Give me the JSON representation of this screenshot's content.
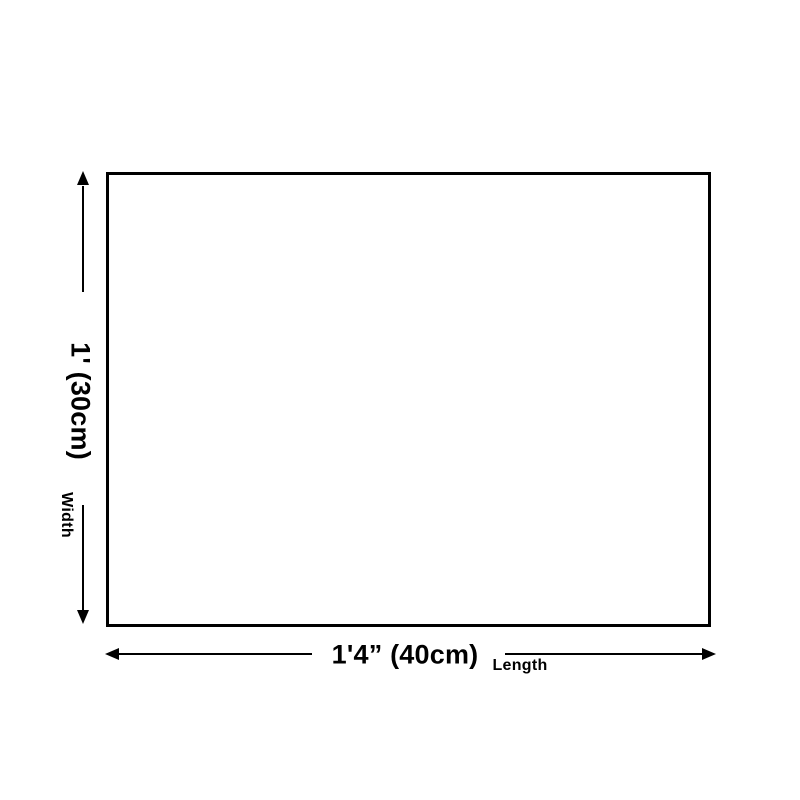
{
  "diagram": {
    "background_color": "#ffffff",
    "line_color": "#000000",
    "shape": "rectangle-outline",
    "vertical_dimension": {
      "value": "1' (30cm)",
      "axis_label": "Width"
    },
    "horizontal_dimension": {
      "value": "1'4” (40cm)",
      "axis_label": "Length"
    }
  }
}
